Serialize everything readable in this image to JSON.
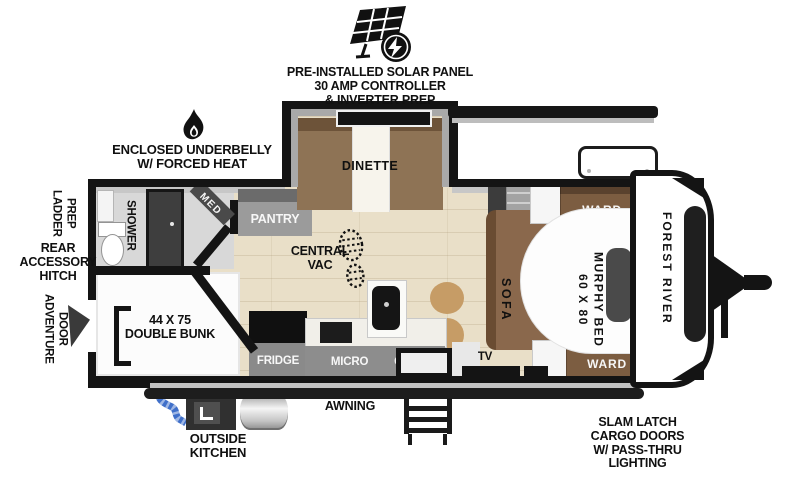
{
  "callouts": {
    "solar": {
      "l1": "PRE-INSTALLED SOLAR PANEL",
      "l2": "30 AMP CONTROLLER",
      "l3": "& INVERTER PREP"
    },
    "underbelly": {
      "l1": "ENCLOSED UNDERBELLY",
      "l2": "W/ FORCED HEAT"
    },
    "ladder_prep": {
      "l1": "LADDER",
      "l2": "PREP"
    },
    "rear_hitch": {
      "l1": "REAR",
      "l2": "ACCESSORY",
      "l3": "HITCH"
    },
    "adventure_door": {
      "l1": "ADVENTURE",
      "l2": "DOOR"
    },
    "awning": "AWNING",
    "outside_kitchen": {
      "l1": "OUTSIDE",
      "l2": "KITCHEN"
    },
    "cargo": {
      "l1": "SLAM LATCH",
      "l2": "CARGO DOORS",
      "l3": "W/ PASS-THRU",
      "l4": "LIGHTING"
    }
  },
  "interior": {
    "shower": "SHOWER",
    "med": "MED",
    "pantry": "PANTRY",
    "dinette": "DINETTE",
    "central_vac": {
      "l1": "CENTRAL",
      "l2": "VAC"
    },
    "double_bunk": {
      "l1": "44 X 75",
      "l2": "DOUBLE BUNK"
    },
    "fridge": "FRIDGE",
    "micro": "MICRO",
    "ohc": "OHC",
    "tv": "TV",
    "sofa": "SOFA",
    "murphy_bed": {
      "l1": "60 X 80",
      "l2": "MURPHY BED"
    },
    "ward_front": "WARD",
    "ward_rear": "WARD"
  },
  "brand": {
    "name": "FOREST RIVER"
  },
  "icons": {
    "solar_panel": "solar-panel-bolt-icon",
    "forced_heat": "flame-icon",
    "central_vac": "footprint-icon",
    "adventure_door_arrow": "wedge-arrow-icon",
    "outside_kitchen_hose": "blue-hose-icon",
    "entry_steps": "ladder-steps-icon"
  },
  "colors": {
    "wall": "#141414",
    "floor_wood": "#e9dfc8",
    "bath_floor": "#d8d8d8",
    "cabinet_gray": "#8d8d8d",
    "wood_brown": "#7c5d41",
    "sofa_brown": "#8a684c",
    "stool_tan": "#c69c66",
    "hose_blue": "#3f6fc9"
  }
}
